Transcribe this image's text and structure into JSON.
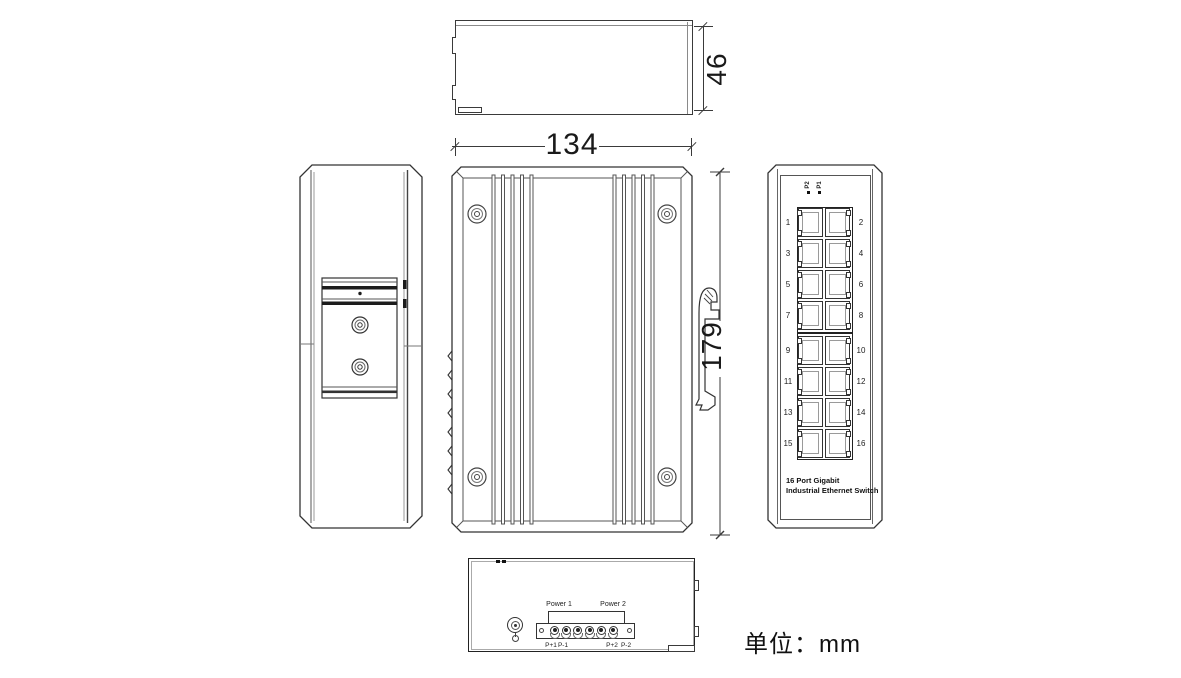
{
  "meta": {
    "unit_label": "单位：mm"
  },
  "dimensions": {
    "depth_mm": "46",
    "width_mm": "134",
    "height_mm": "179"
  },
  "front_view": {
    "led_labels": [
      "P2",
      "P1"
    ],
    "caption_line1": "16 Port Gigabit",
    "caption_line2": "Industrial Ethernet Switch",
    "port_rows": [
      {
        "left": "1",
        "right": "2"
      },
      {
        "left": "3",
        "right": "4"
      },
      {
        "left": "5",
        "right": "6"
      },
      {
        "left": "7",
        "right": "8"
      },
      {
        "left": "9",
        "right": "10"
      },
      {
        "left": "11",
        "right": "12"
      },
      {
        "left": "13",
        "right": "14"
      },
      {
        "left": "15",
        "right": "16"
      }
    ]
  },
  "bottom_view": {
    "power1_label": "Power 1",
    "power2_label": "Power 2",
    "terminal_labels": [
      "P+1",
      "P-1",
      "P+2",
      "P-2"
    ]
  },
  "colors": {
    "line": "#3a3a3a",
    "line_dark": "#111111",
    "line_light": "#8a8a8a",
    "background": "#ffffff"
  }
}
